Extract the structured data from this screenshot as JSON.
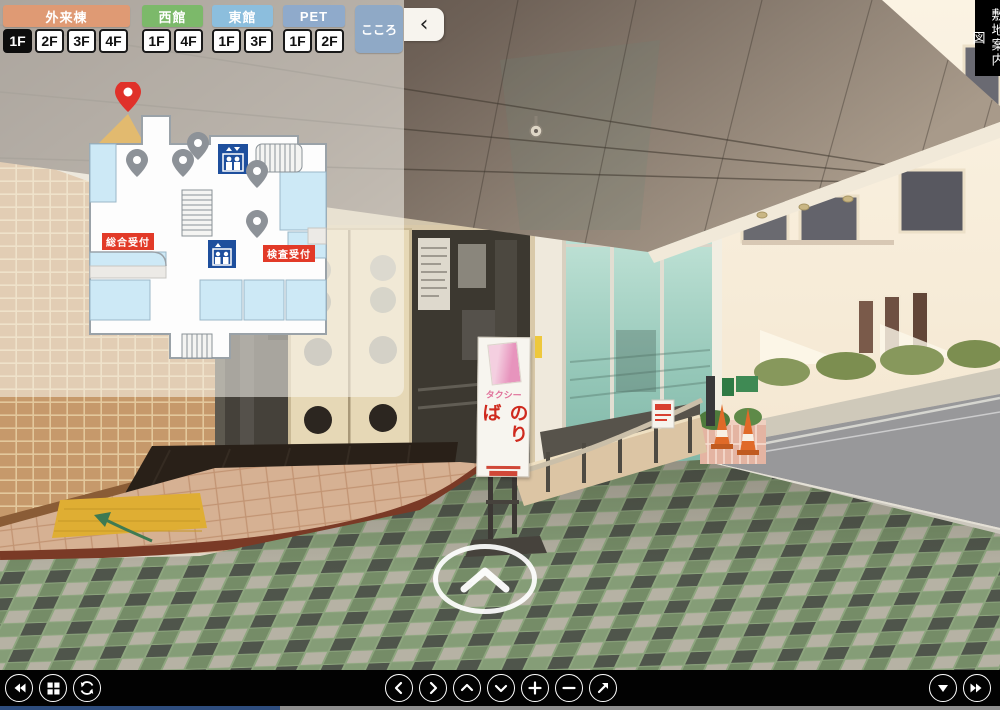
{
  "panel": {
    "buildings": [
      {
        "name": "外来棟",
        "color": "#df9a74",
        "floors": [
          {
            "label": "1F",
            "selected": true
          },
          {
            "label": "2F",
            "selected": false
          },
          {
            "label": "3F",
            "selected": false
          },
          {
            "label": "4F",
            "selected": false
          }
        ]
      },
      {
        "name": "西館",
        "color": "#7cb96a",
        "floors": [
          {
            "label": "1F",
            "selected": false
          },
          {
            "label": "4F",
            "selected": false
          }
        ]
      },
      {
        "name": "東館",
        "color": "#8cbedd",
        "floors": [
          {
            "label": "1F",
            "selected": false
          },
          {
            "label": "3F",
            "selected": false
          }
        ]
      },
      {
        "name": "PET",
        "color": "#8faacb",
        "floors": [
          {
            "label": "1F",
            "selected": false
          },
          {
            "label": "2F",
            "selected": false
          }
        ]
      }
    ],
    "kokoro": {
      "label": "こころ",
      "color": "#8fa9c6"
    },
    "collapse": {
      "icon": "‹",
      "icon_name": "chevron-left-collapse-icon"
    }
  },
  "floor_map": {
    "labels": {
      "general_reception": "総合受付",
      "exam_reception": "検査受付"
    },
    "colors": {
      "current_marker": "#e0312a",
      "view_cone": "#edbd62",
      "viewpoint_marker": "#8d9298",
      "elevator": "#1e4f9d",
      "room_fill": "#cde9f6",
      "label_bg": "#e23a28"
    },
    "icons": [
      "current-position-pin",
      "viewpoint-pin",
      "elevator-icon",
      "stairs-icon"
    ]
  },
  "site_map_label": "敷地案内図",
  "scene": {
    "taxi_sign": {
      "top": "タクシー",
      "main": "のりば"
    },
    "hotspot_icon": "chevron-up-hotspot"
  },
  "toolbar": {
    "left_icons": [
      "fast-rewind",
      "thumbnail-grid",
      "auto-rotate"
    ],
    "center_icons": [
      "pan-left",
      "pan-right",
      "pan-up",
      "pan-down",
      "zoom-in",
      "zoom-out",
      "fullscreen"
    ],
    "right_icons": [
      "hide-controls",
      "fast-forward"
    ]
  }
}
